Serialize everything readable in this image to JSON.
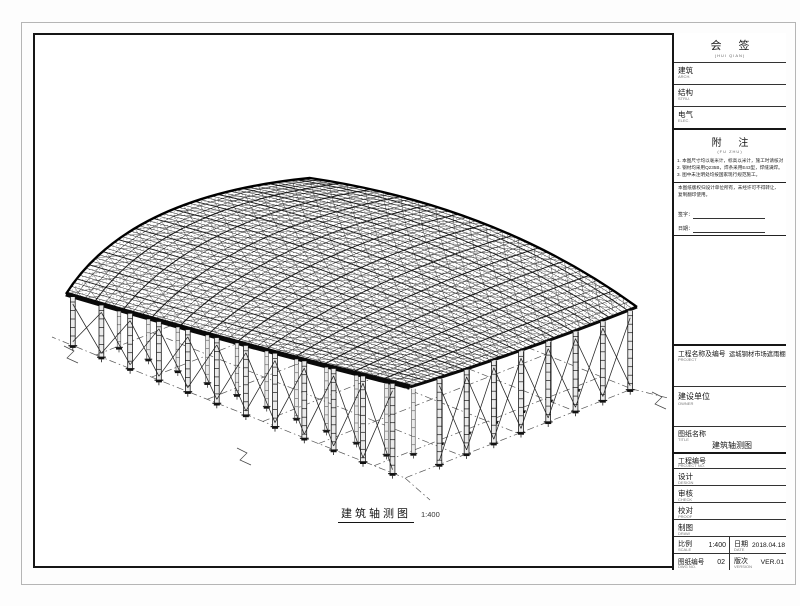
{
  "drawing": {
    "caption": "建筑轴测图",
    "scale_label": "1:400"
  },
  "title_block": {
    "countersign": {
      "title": "会 签",
      "subtitle": "(HUI QIAN)",
      "rows": [
        {
          "label": "建筑",
          "sub": "ARCH."
        },
        {
          "label": "结构",
          "sub": "STRU."
        },
        {
          "label": "电气",
          "sub": "ELEC."
        }
      ]
    },
    "notes": {
      "title": "附 注",
      "subtitle": "(FU ZHU)",
      "items": [
        "1. 本图尺寸均以毫米计，标高以米计，施工时请核对。",
        "2. 钢材均采用Q235B，焊条采用E43型，焊缝满焊。",
        "3. 图中未注明处均按国家现行规范施工。"
      ],
      "copyright": "本图纸版权归设计单位所有，未经许可不得转让、复制翻印使用。",
      "sign_label": "签字：",
      "date_label": "日期："
    },
    "project": {
      "label": "工程名称及编号",
      "sub": "PROJECT",
      "value": "运城钢材市场遮雨棚"
    },
    "owner": {
      "label": "建设单位",
      "sub": "OWNER"
    },
    "dwg_title": {
      "label": "图纸名称",
      "sub": "TITLE",
      "value": "建筑轴测图"
    },
    "rows": [
      {
        "label": "工程编号",
        "sub": "PROJECT NO."
      },
      {
        "label": "设计",
        "sub": "DESIGN"
      },
      {
        "label": "审核",
        "sub": "CHECK"
      },
      {
        "label": "校对",
        "sub": "PROOF"
      },
      {
        "label": "制图",
        "sub": "DRAW"
      }
    ],
    "scale": {
      "label": "比例",
      "sub": "SCALE",
      "value": "1:400"
    },
    "date": {
      "label": "日期",
      "sub": "DATE",
      "value": "2018.04.18"
    },
    "dwg_no": {
      "label": "图纸编号",
      "sub": "DWG NO.",
      "value": "02"
    },
    "version": {
      "label": "版次",
      "sub": "VERSION",
      "value": "VER.01"
    }
  }
}
